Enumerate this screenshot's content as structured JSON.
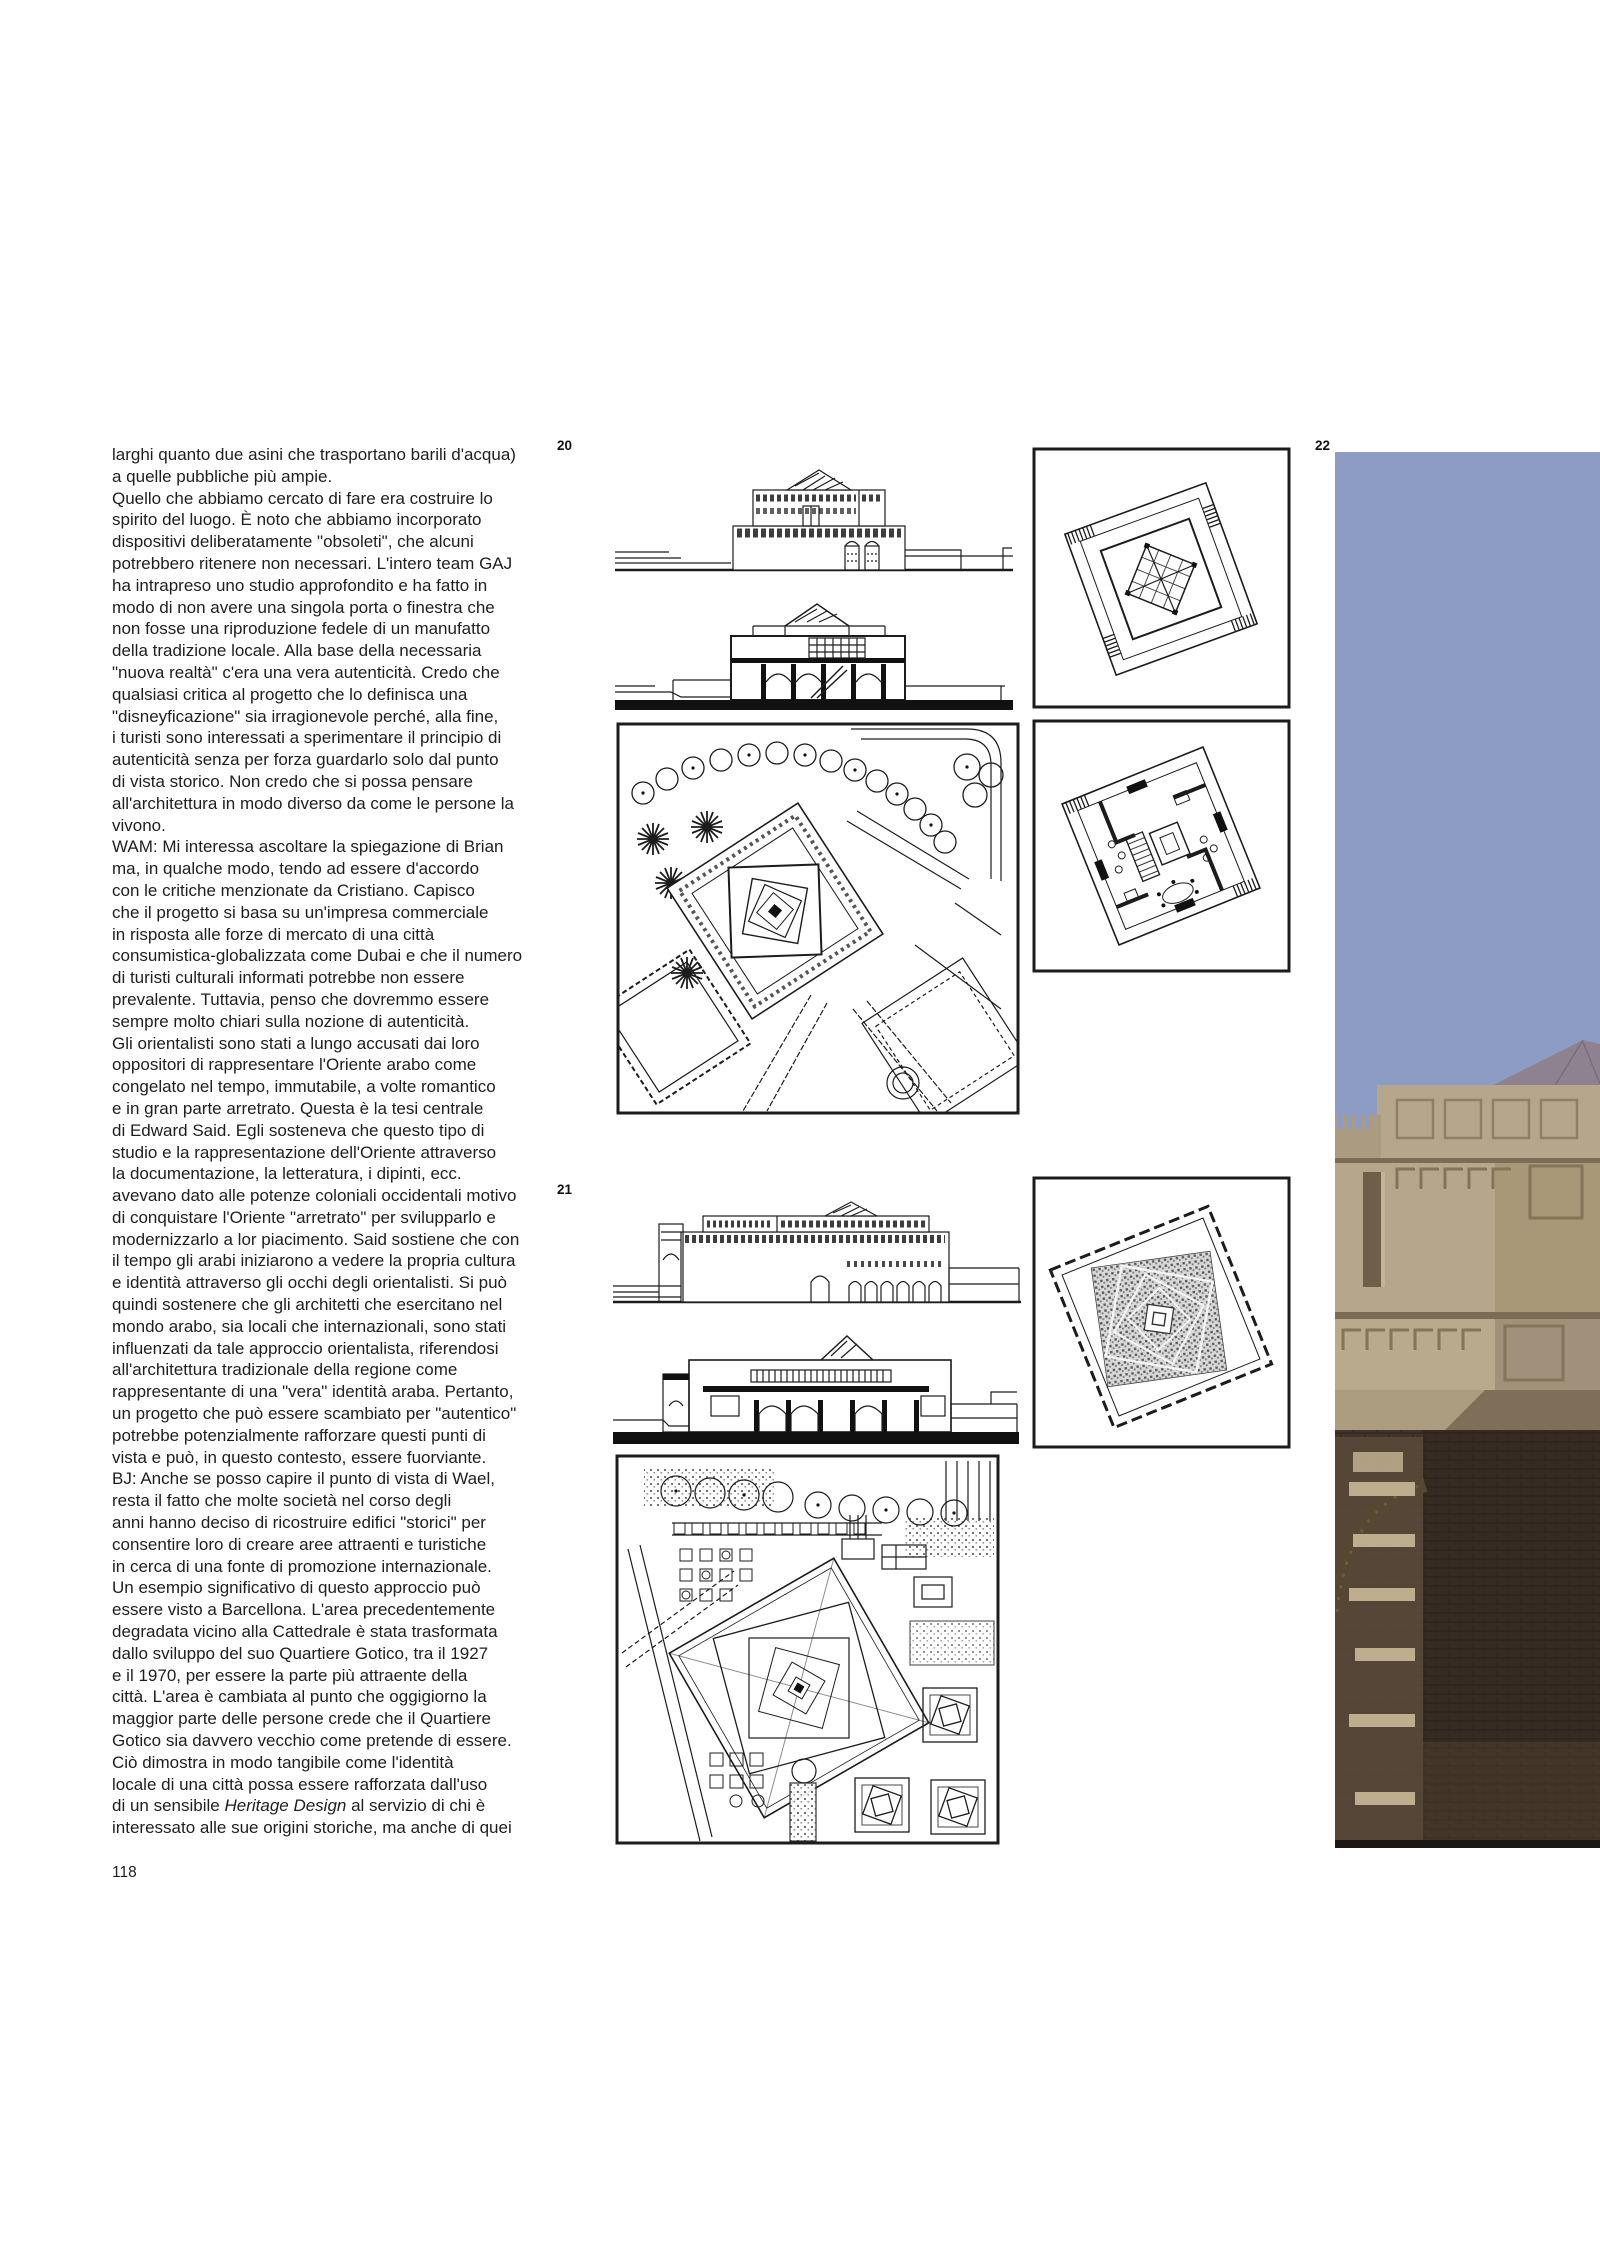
{
  "page": {
    "number": "118"
  },
  "figures": {
    "fig20_label": "20",
    "fig21_label": "21",
    "fig22_label": "22"
  },
  "article": {
    "body_before_italic": "larghi quanto due asini che trasportano barili d'acqua)\na quelle pubbliche più ampie.\nQuello che abbiamo cercato di fare era costruire lo\nspirito del luogo. È noto che abbiamo incorporato\ndispositivi deliberatamente \"obsoleti\", che alcuni\npotrebbero ritenere non necessari. L'intero team GAJ\nha intrapreso uno studio approfondito e ha fatto in\nmodo di non avere una singola porta o finestra che\nnon fosse una riproduzione fedele di un manufatto\ndella tradizione locale. Alla base della necessaria\n\"nuova realtà\" c'era una vera autenticità. Credo che\nqualsiasi critica al progetto che lo definisca una\n\"disneyficazione\" sia irragionevole perché, alla fine,\ni turisti sono interessati a sperimentare il principio di\nautenticità senza per forza guardarlo solo dal punto\ndi vista storico. Non credo che si possa pensare\nall'architettura in modo diverso da come le persone la\nvivono.\nWAM: Mi interessa ascoltare la spiegazione di Brian\nma, in qualche modo, tendo ad essere d'accordo\ncon le critiche menzionate da Cristiano. Capisco\nche il progetto si basa su un'impresa commerciale\nin risposta alle forze di mercato di una città\nconsumistica-globalizzata come Dubai e che il numero\ndi turisti culturali informati potrebbe non essere\nprevalente. Tuttavia, penso che dovremmo essere\nsempre molto chiari sulla nozione di autenticità.\nGli orientalisti sono stati a lungo accusati dai loro\noppositori di rappresentare l'Oriente arabo come\ncongelato nel tempo, immutabile, a volte romantico\ne in gran parte arretrato. Questa è la tesi centrale\ndi Edward Said. Egli sosteneva che questo tipo di\nstudio e la rappresentazione dell'Oriente attraverso\nla documentazione, la letteratura, i dipinti, ecc.\navevano dato alle potenze coloniali occidentali motivo\ndi conquistare l'Oriente \"arretrato\" per svilupparlo e\nmodernizzarlo a lor piacimento. Said sostiene che con\nil tempo gli arabi iniziarono a vedere la propria cultura\ne identità attraverso gli occhi degli orientalisti. Si può\nquindi sostenere che gli architetti che esercitano nel\nmondo arabo, sia locali che internazionali, sono stati\ninfluenzati da tale approccio orientalista, riferendosi\nall'architettura tradizionale della regione come\nrappresentante di una \"vera\" identità araba. Pertanto,\nun progetto che può essere scambiato per \"autentico\"\npotrebbe potenzialmente rafforzare questi punti di\nvista e può, in questo contesto, essere fuorviante.\nBJ: Anche se posso capire il punto di vista di Wael,\nresta il fatto che molte società nel corso degli\nanni hanno deciso di ricostruire edifici \"storici\" per\nconsentire loro di creare aree attraenti e turistiche\nin cerca di una fonte di promozione internazionale.\nUn esempio significativo di questo approccio può\nessere visto a Barcellona. L'area precedentemente\ndegradata vicino alla Cattedrale è stata trasformata\ndallo sviluppo del suo Quartiere Gotico, tra il 1927\ne il 1970, per essere la parte più attraente della\ncittà. L'area è cambiata al punto che oggigiorno la\nmaggior parte delle persone crede che il Quartiere\nGotico sia davvero vecchio come pretende di essere.\nCiò dimostra in modo tangibile come l'identità\nlocale di una città possa essere rafforzata dall'uso\ndi un sensibile ",
    "italic_phrase": "Heritage Design",
    "body_after_italic": " al servizio di chi è\ninteressato alle sue origini storiche, ma anche di quei"
  },
  "colors": {
    "sky": "#8d9cc5",
    "roof": "#8e8290",
    "wall-light": "#b6a78c",
    "wall-mid": "#a89878",
    "wall-shadow": "#7c6c55",
    "brick-dark": "#3a2e23",
    "brick-mid": "#4a3b2c",
    "stripe-light": "#c8b795",
    "ink": "#1c1c1c"
  }
}
